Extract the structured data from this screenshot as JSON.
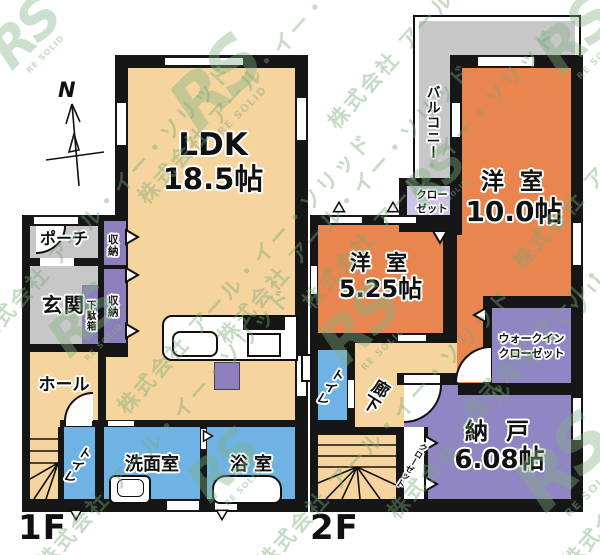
{
  "watermark": {
    "company": "株式会社 アール・イー・ソリッド",
    "logo": "RS",
    "logo_sub": "RE SOLID",
    "color": "#86b286"
  },
  "compass": {
    "north_label": "N"
  },
  "palette": {
    "wall": "#161616",
    "background": "#FFFFFF"
  },
  "floor_1f": {
    "label": "1F",
    "rooms": {
      "ldk": {
        "name": "LDK",
        "area": "18.5帖",
        "color": "#F6D49E"
      },
      "porch": {
        "name": "ポーチ",
        "color": "#C7C7C7"
      },
      "entrance": {
        "name": "玄関",
        "color": "#C7C7C7"
      },
      "shoe_cabinet": {
        "name": "下駄箱",
        "color": "#8C7FBC"
      },
      "storage_upper": {
        "name": "収納",
        "color": "#8C7FBC"
      },
      "storage_lower": {
        "name": "収納",
        "color": "#8C7FBC"
      },
      "hall": {
        "name": "ホール",
        "color": "#F6D49E"
      },
      "toilet": {
        "name": "トイレ",
        "color": "#6FB3E5"
      },
      "washroom": {
        "name": "洗面室",
        "color": "#6FB3E5"
      },
      "bathroom": {
        "name": "浴 室",
        "color": "#6FB3E5"
      },
      "kitchen_island": {
        "color": "#8C7FBC"
      }
    }
  },
  "floor_2f": {
    "label": "2F",
    "rooms": {
      "balcony": {
        "name": "バルコニー",
        "color": "#C7C7C7"
      },
      "western_room_10": {
        "name": "洋 室",
        "area": "10.0帖",
        "color": "#E9854F"
      },
      "closet_main": {
        "name_line1": "クロー",
        "name_line2": "ゼット",
        "color": "#CCC4E6"
      },
      "western_room_525": {
        "name": "洋 室",
        "area": "5.25帖",
        "color": "#E9854F"
      },
      "toilet": {
        "name": "トイレ",
        "color": "#6FB3E5"
      },
      "corridor": {
        "name": "廊下",
        "color": "#F6D49E"
      },
      "walk_in_closet": {
        "name_line1": "ウォークイン",
        "name_line2": "クローゼット",
        "color": "#9186C4"
      },
      "storeroom": {
        "name": "納 戸",
        "area": "6.08帖",
        "color": "#9186C4"
      },
      "closet_side": {
        "name": "クローゼット",
        "color": "#FFFFFF"
      }
    }
  }
}
